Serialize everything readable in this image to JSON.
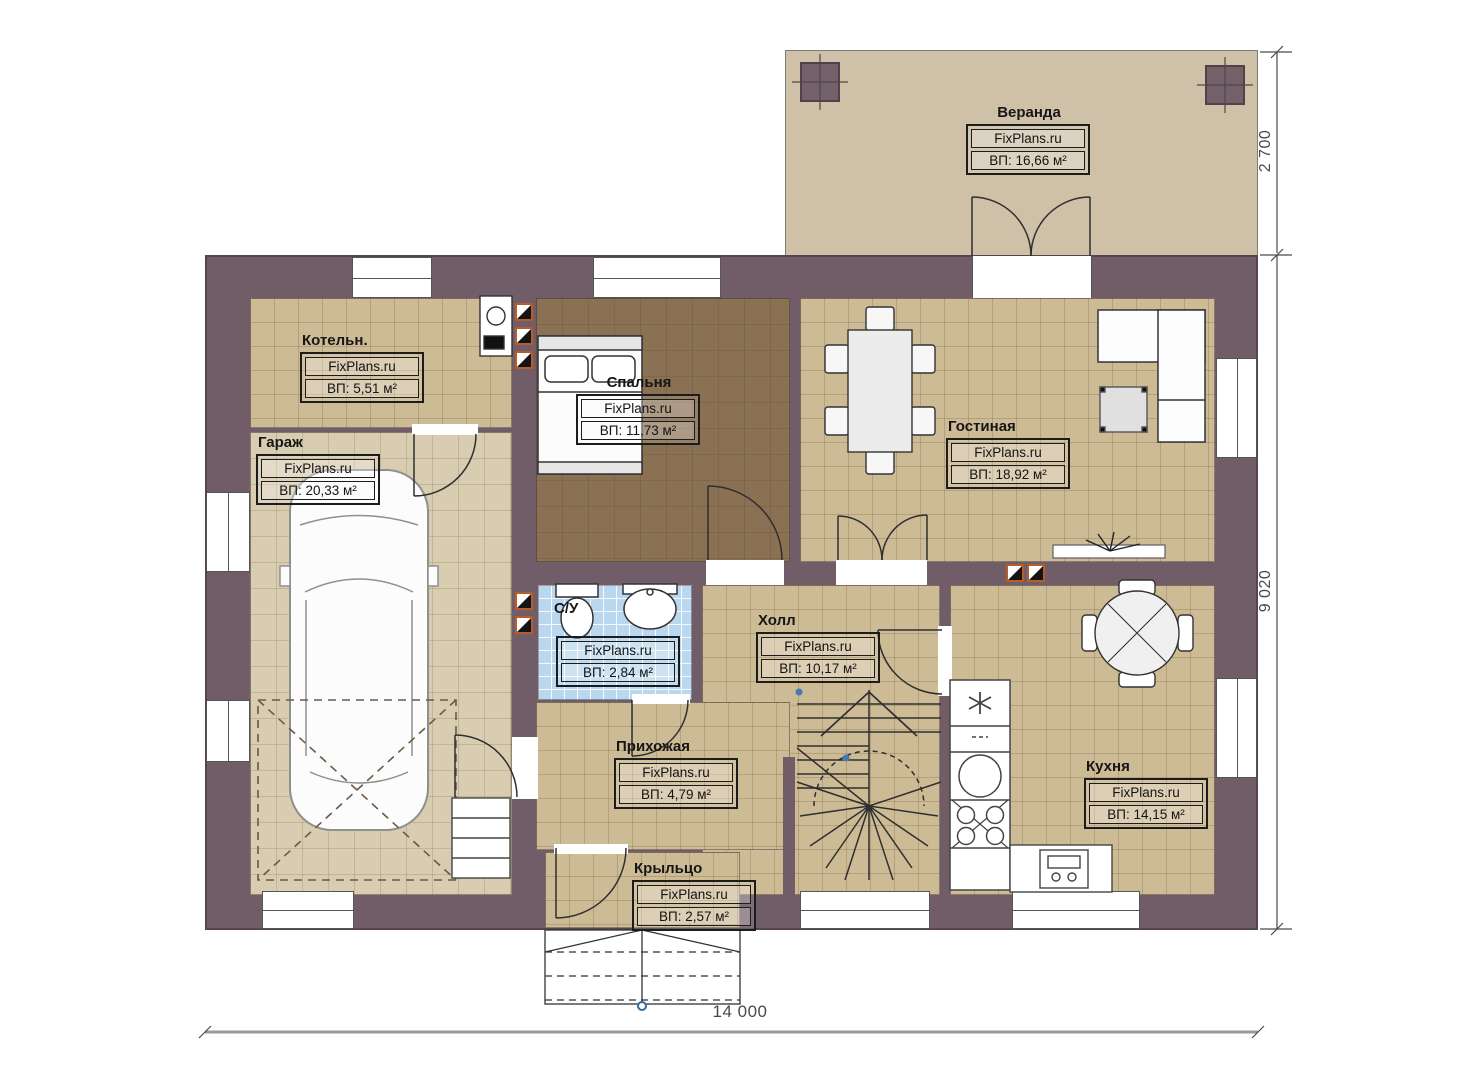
{
  "watermark": "FixPlans.ru",
  "rooms": [
    {
      "id": "veranda",
      "name": "Веранда",
      "area": "ВП: 16,66 м²"
    },
    {
      "id": "boiler",
      "name": "Котельн.",
      "area": "ВП: 5,51 м²"
    },
    {
      "id": "garage",
      "name": "Гараж",
      "area": "ВП: 20,33 м²"
    },
    {
      "id": "bedroom",
      "name": "Спальня",
      "area": "ВП: 11,73 м²"
    },
    {
      "id": "living",
      "name": "Гостиная",
      "area": "ВП: 18,92 м²"
    },
    {
      "id": "bathroom",
      "name": "С/У",
      "area": "ВП: 2,84 м²"
    },
    {
      "id": "hall",
      "name": "Холл",
      "area": "ВП: 10,17 м²"
    },
    {
      "id": "entry",
      "name": "Прихожая",
      "area": "ВП: 4,79 м²"
    },
    {
      "id": "kitchen",
      "name": "Кухня",
      "area": "ВП: 14,15 м²"
    },
    {
      "id": "porch",
      "name": "Крыльцо",
      "area": "ВП: 2,57 м²"
    }
  ],
  "dimensions": {
    "veranda_depth": "2 700",
    "house_height": "9 020",
    "house_width": "14 000"
  },
  "colors": {
    "wall": "#705d67",
    "floor_tan": "#cdbb96",
    "floor_garage": "#d8ccb1",
    "floor_bedroom": "#8a7154",
    "floor_bathroom": "#b9d7ee",
    "veranda_floor": "#cfc0a8",
    "vent_accent": "#b85c28",
    "dimension_text": "#4a4a4a"
  }
}
